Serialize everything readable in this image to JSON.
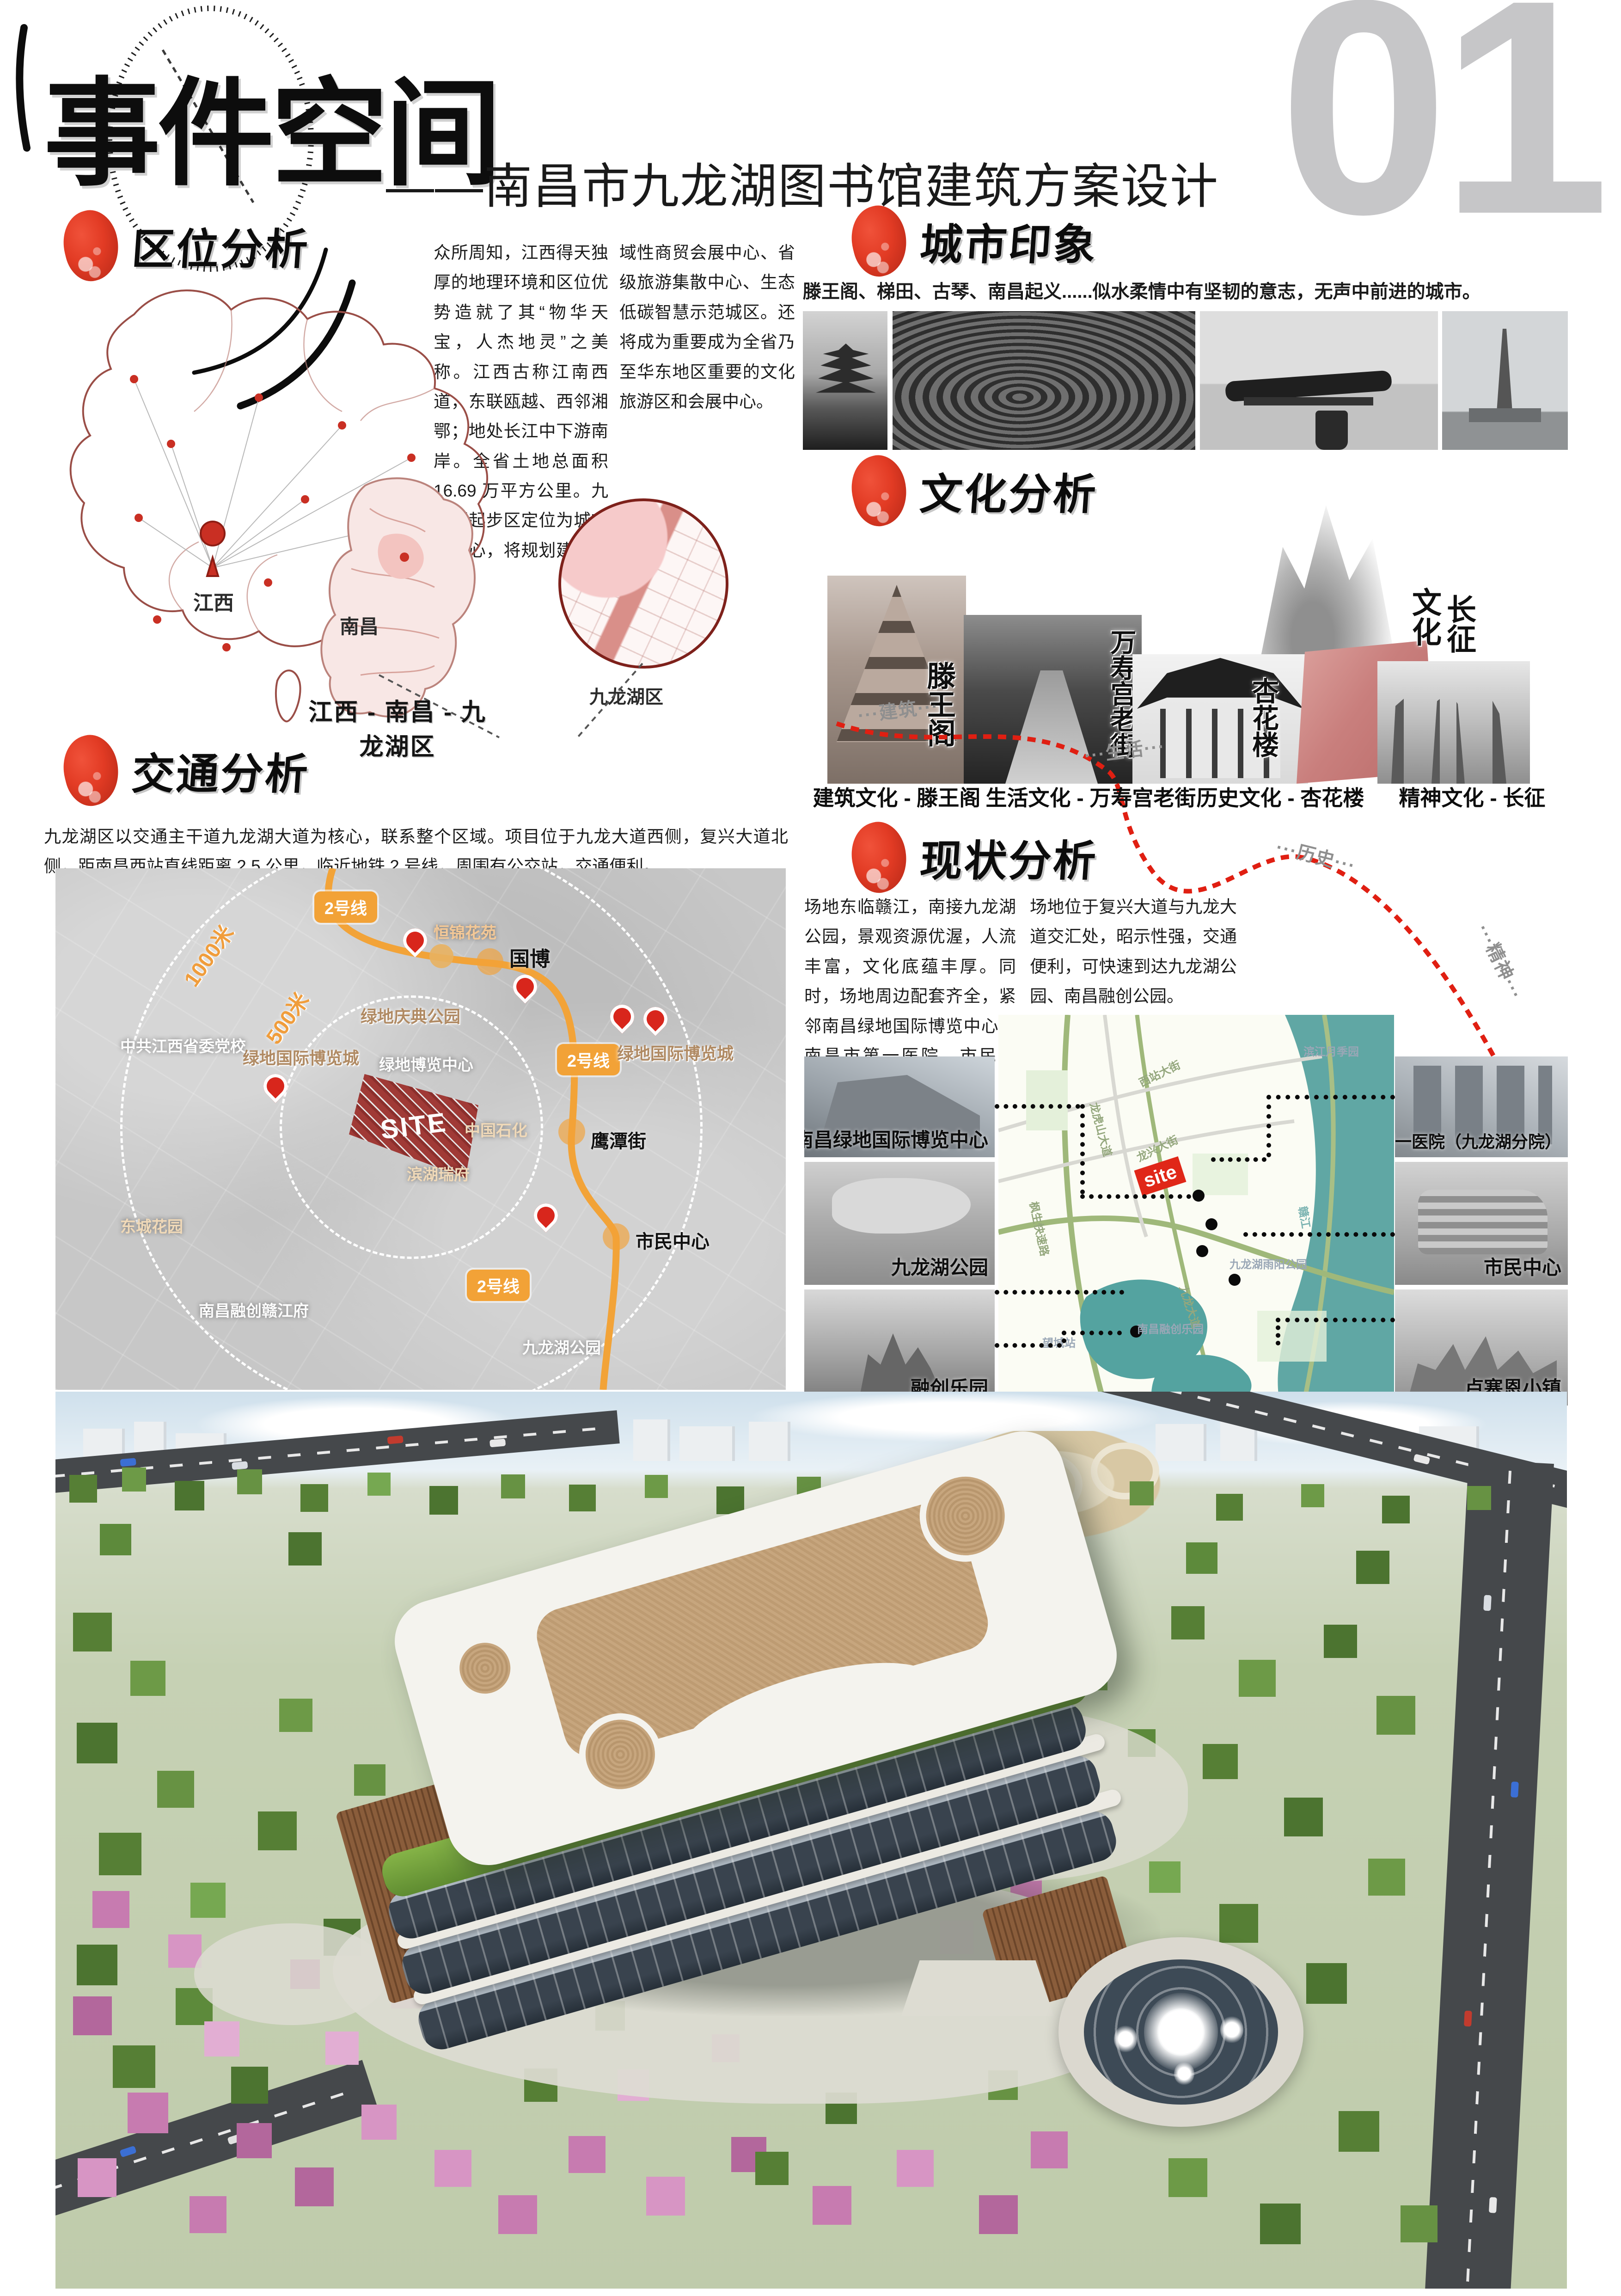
{
  "page": {
    "board_no": "01",
    "title": "事件空间",
    "subtitle": "——南昌市九龙湖图书馆建筑方案设计"
  },
  "colors": {
    "accent_red": "#e23b24",
    "metro_orange": "#f2a237",
    "site_red": "#a03a36",
    "river_teal": "#4f9d9b",
    "number_gray": "#c6c6c8"
  },
  "location": {
    "title": "区位分析",
    "para1": "众所周知，江西得天独厚的地理环境和区位优势造就了其“物华天宝，人杰地灵”之美称。江西古称江南西道，东联瓯越、西邻湘鄂；地处长江中下游南岸。全省土地总面积 16.69 万平方公里。九龙湖起步区定位为城市副中心，将规划建设成为区",
    "para2": "域性商贸会展中心、省级旅游集散中心、生态低碳智慧示范城区。还将成为重要成为全省乃至华东地区重要的文化旅游区和会展中心。",
    "label_jiangxi": "江西",
    "label_nanchang": "南昌",
    "label_jiulonghu": "九龙湖区",
    "caption": "江西 - 南昌 - 九龙湖区"
  },
  "city": {
    "title": "城市印象",
    "caption": "滕王阁、梯田、古琴、南昌起义......似水柔情中有坚韧的意志，无声中前进的城市。",
    "photos": [
      "tengwangge-pavilion",
      "terraced-fields",
      "guqin",
      "bayi-monument"
    ]
  },
  "culture": {
    "title": "文化分析",
    "route_labels": [
      "···建筑···",
      "···生活···",
      "···历史···",
      "···精神···"
    ],
    "calligraphy": {
      "tengwangge": "滕王阁",
      "wanshougong": "万寿宫老街",
      "xinghualou": "杏花楼",
      "changzheng_left": "文化",
      "changzheng_right": "长征"
    },
    "captions": [
      "建筑文化 - 滕王阁",
      "生活文化 - 万寿宫老街",
      "历史文化 - 杏花楼",
      "精神文化 - 长征"
    ]
  },
  "traffic": {
    "title": "交通分析",
    "paragraph": "九龙湖区以交通主干道九龙湖大道为核心，联系整个区域。项目位于九龙大道西侧，复兴大道北侧，距南昌西站直线距离 2.5 公里，临近地铁 2 号线，周围有公交站，交通便利。",
    "line_badge": "2号线",
    "ring_500": "500米",
    "ring_1000": "1000米",
    "site": "SITE",
    "station_guobo": "国博",
    "station_yingtanjie": "鹰潭街",
    "station_shimin": "市民中心",
    "labels": {
      "hengjin": "恒锦花苑",
      "qingdian": "绿地庆典公园",
      "bolancheng": "绿地国际博览城",
      "dangxiao": "中共江西省委党校",
      "bolan_center": "绿地博览中心",
      "bolancheng2": "绿地国际博览城",
      "sinopec": "中国石化",
      "binhu": "滨湖瑞府",
      "dongcheng": "东城花园",
      "rongchuang": "南昌融创赣江府",
      "jiulonghu_park": "九龙湖公园"
    }
  },
  "status": {
    "title": "现状分析",
    "para1": "场地东临赣江，南接九龙湖公园，景观资源优渥，人流丰富，文化底蕴丰厚。同时，场地周边配套齐全，紧邻南昌绿地国际博览中心、南昌市第一医院、市民中心、卢塞恩小镇等。",
    "para2": "场地位于复兴大道与九龙大道交汇处，昭示性强，交通便利，可快速到达九龙湖公园、南昌融创公园。",
    "left_photos": [
      "南昌绿地国际博览中心",
      "九龙湖公园",
      "融创乐园"
    ],
    "right_photos": [
      "南昌市第一医院（九龙湖分院）",
      "市民中心",
      "卢塞恩小镇"
    ],
    "map": {
      "site": "site",
      "roads": [
        "西站大街",
        "龙兴大街",
        "枫生快速路",
        "龙虎山大道",
        "九龙大道",
        "赣江",
        "望城站",
        "滨江月季园",
        "九龙湖雨阳公园",
        "南昌融创乐园"
      ]
    }
  }
}
